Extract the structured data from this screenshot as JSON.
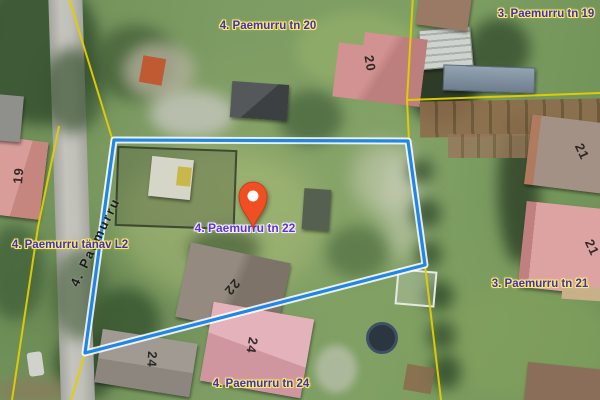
{
  "map": {
    "labels": {
      "tn20": "4. Paemurru tn 20",
      "tn19": "3. Paemurru tn 19",
      "tanav_l2": "4. Paemurru tänav L2",
      "tn22": "4. Paemurru tn 22",
      "tn21": "3. Paemurru tn 21",
      "tn24": "4. Paemurru tn 24",
      "street": "4. Paemurru"
    },
    "house_numbers": {
      "n20": "20",
      "n19": "19",
      "n21a": "21",
      "n21b": "21",
      "n22": "22",
      "n24a": "24",
      "n24b": "24"
    },
    "marker": {
      "color": "#f04e23"
    },
    "colors": {
      "parcel_label_text": "#3a30d0",
      "parcel_label_halo": "#ffe95e",
      "selected_label_text": "#5f35c8",
      "selected_label_halo": "#f2eeff",
      "cadastral_line": "#e3cf00",
      "selection_outline": "#1f87e8",
      "street_label_text": "#1c1c1c"
    }
  }
}
